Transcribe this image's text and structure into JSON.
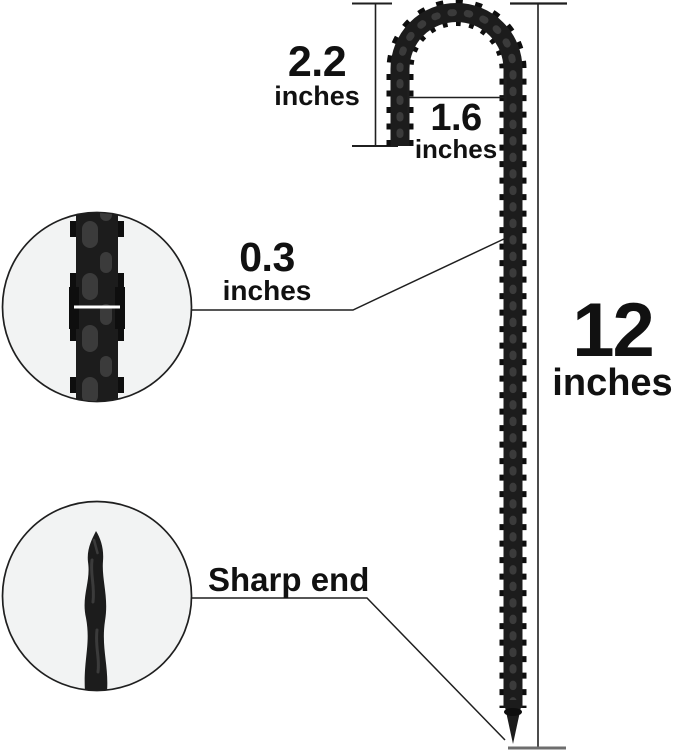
{
  "diagram": {
    "measurements": {
      "hook_height": {
        "value": "2.2",
        "unit": "inches"
      },
      "hook_opening": {
        "value": "1.6",
        "unit": "inches"
      },
      "rod_diameter": {
        "value": "0.3",
        "unit": "inches"
      },
      "total_length": {
        "value": "12",
        "unit": "inches"
      }
    },
    "callouts": {
      "tip_label": "Sharp end"
    },
    "colors": {
      "background": "#ffffff",
      "stake_black": "#1c1c1c",
      "rib_black": "#0e0e0e",
      "sheen_gray": "#3b3b3b",
      "text_black": "#111111",
      "line_color": "#1f1f1f",
      "circle_fill": "#f2f3f3",
      "ground_tick_gray": "#6e6e6e",
      "measure_white": "#ffffff"
    }
  }
}
